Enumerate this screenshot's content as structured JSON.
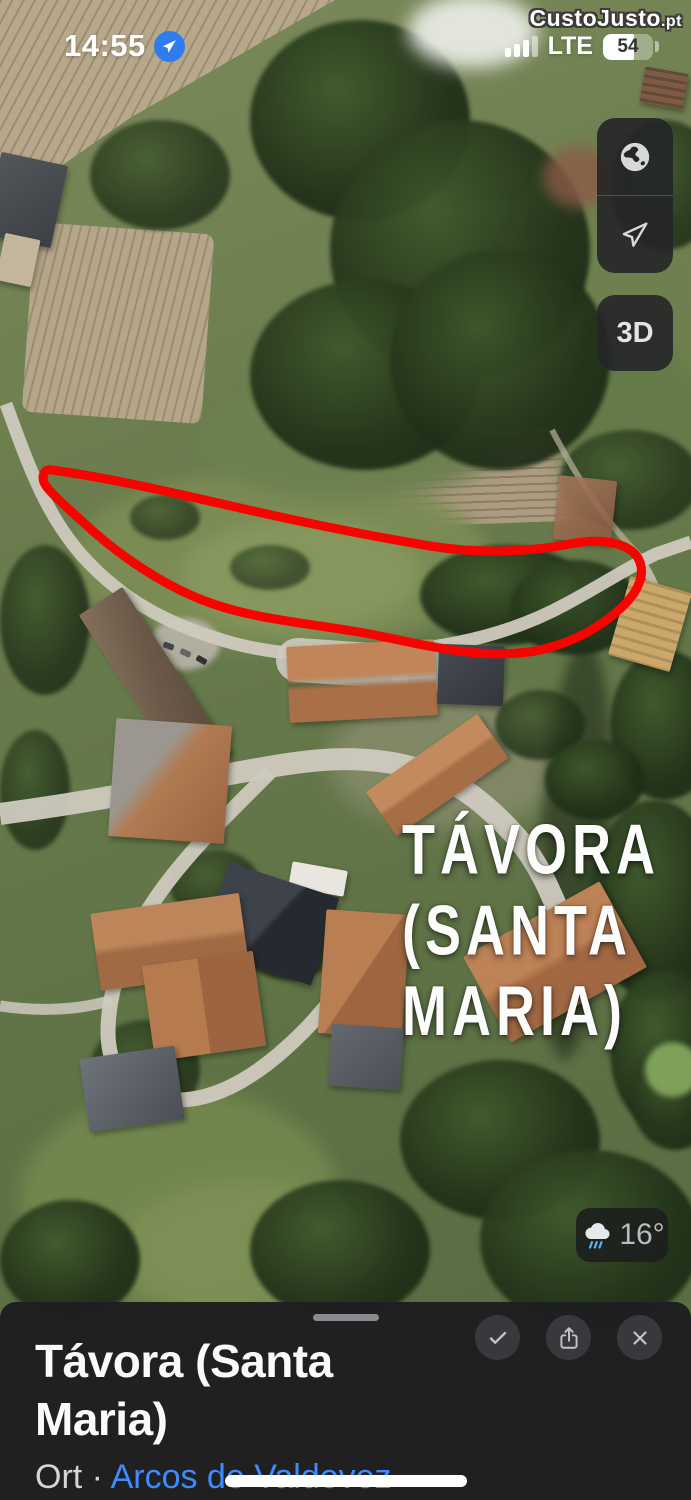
{
  "status_bar": {
    "time": "14:55",
    "network": "LTE",
    "battery_percent": "54"
  },
  "watermark": {
    "brand": "CustoJusto",
    "tld": ".pt"
  },
  "map_controls": {
    "mode_3d_label": "3D"
  },
  "map": {
    "place_label_line1": "TÁVORA",
    "place_label_line2": "(SANTA",
    "place_label_line3": "MARIA)",
    "weather_temp": "16°"
  },
  "bottom_sheet": {
    "title": "Távora (Santa Maria)",
    "category": "Ort",
    "separator": "·",
    "region_link": "Arcos de Valdevez"
  },
  "colors": {
    "plot_outline_red": "#f50400",
    "link_blue": "#3e8bff",
    "location_badge_blue": "#2e7cf0",
    "sheet_background": "#1f1f21"
  }
}
